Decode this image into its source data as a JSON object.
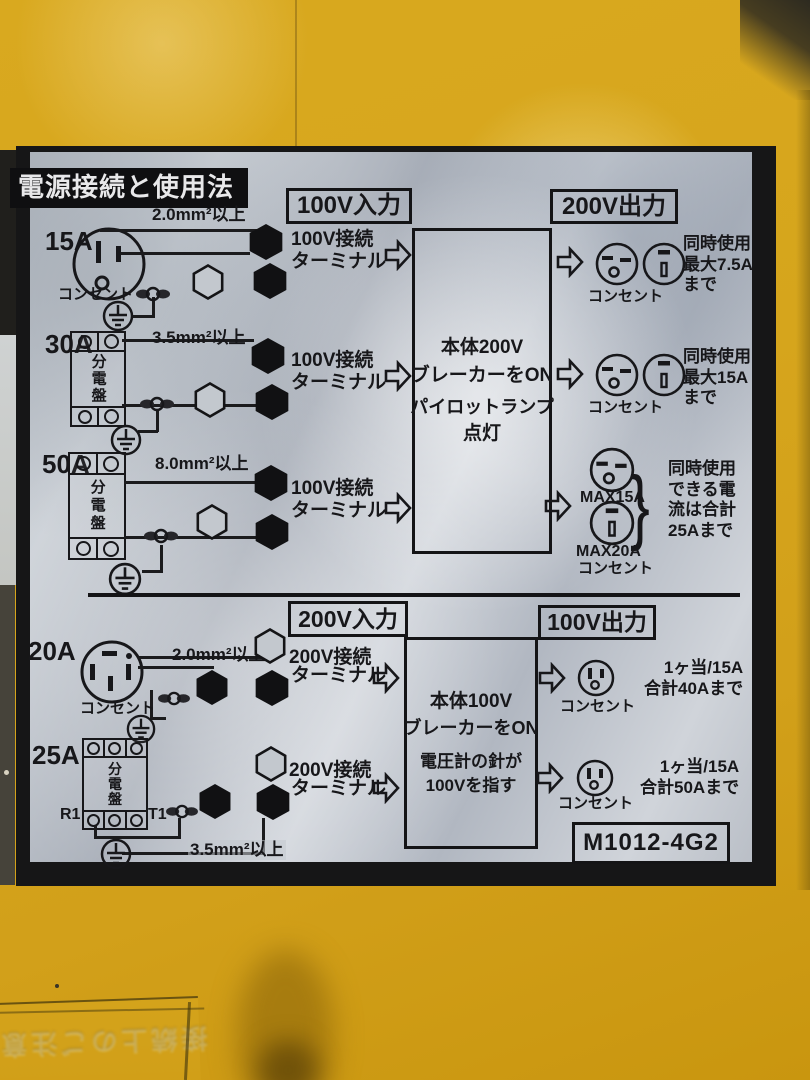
{
  "plate": {
    "title": "電源接続と使用法",
    "model": "M1012-4G2",
    "bracket": "}",
    "faint_label": "接続上のご注意",
    "sections": [
      {
        "input_header": "100V入力",
        "output_header": "200V出力",
        "center_lines": [
          "本体200V",
          "ブレーカーをON",
          "パイロットランプ",
          "点灯"
        ],
        "rows": [
          {
            "amp": "15A",
            "source_label": "コンセント",
            "wire_label": "2.0mm²以上",
            "terminal_line1": "100V接続",
            "terminal_line2": "ターミナル",
            "out_caption": "コンセント",
            "out_note": [
              "同時使用",
              "最大7.5A",
              "まで"
            ]
          },
          {
            "amp": "30A",
            "source_label": "分電盤",
            "wire_label": "3.5mm²以上",
            "terminal_line1": "100V接続",
            "terminal_line2": "ターミナル",
            "out_caption": "コンセント",
            "out_note": [
              "同時使用",
              "最大15A",
              "まで"
            ]
          },
          {
            "amp": "50A",
            "source_label": "分電盤",
            "wire_label": "8.0mm²以上",
            "terminal_line1": "100V接続",
            "terminal_line2": "ターミナル",
            "out_caption": "コンセント",
            "out_note": [
              "同時使用",
              "できる電",
              "流は合計",
              "25Aまで"
            ],
            "max_labels": [
              "MAX15A",
              "MAX20A"
            ]
          }
        ]
      },
      {
        "input_header": "200V入力",
        "output_header": "100V出力",
        "center_lines": [
          "本体100V",
          "ブレーカーをON",
          "電圧計の針が",
          "100Vを指す"
        ],
        "rows": [
          {
            "amp": "20A",
            "source_label": "コンセント",
            "wire_label": "2.0mm²以上",
            "terminal_line1": "200V接続",
            "terminal_line2": "ターミナル",
            "out_caption": "コンセント",
            "out_note": [
              "1ヶ当/15A",
              "合計40Aまで"
            ]
          },
          {
            "amp": "25A",
            "source_label": "分電盤",
            "wire_label": "3.5mm²以上",
            "terminal_line1": "200V接続",
            "terminal_line2": "ターミナル",
            "out_caption": "コンセント",
            "out_note": [
              "1ヶ当/15A",
              "合計50Aまで"
            ],
            "breaker_terminal_labels": [
              "R1",
              "T1"
            ]
          }
        ]
      }
    ]
  }
}
